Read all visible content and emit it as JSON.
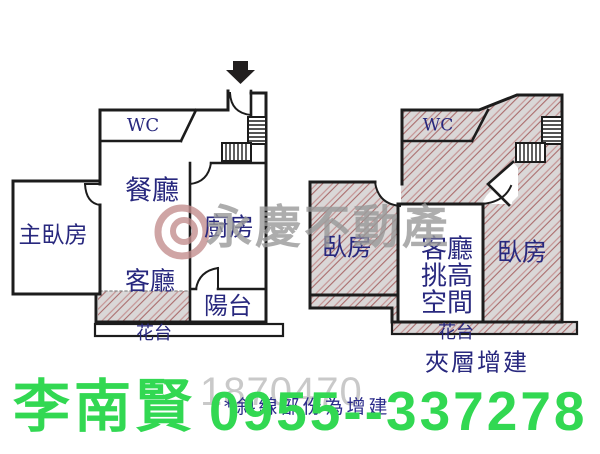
{
  "contact": {
    "name": "李南賢",
    "phone": "0955--337278"
  },
  "watermark": {
    "brand": "永慶不動產",
    "number": "1870470"
  },
  "notes": {
    "hatch_note": "*斜線部份為增建"
  },
  "left_plan": {
    "rooms": {
      "wc": "WC",
      "dining": "餐廳",
      "kitchen": "廚房",
      "master_bedroom": "主臥房",
      "living": "客廳",
      "balcony": "陽台",
      "flower_bed": "花台"
    }
  },
  "right_plan": {
    "rooms": {
      "wc": "WC",
      "bedroom_left": "臥房",
      "bedroom_right": "臥房",
      "flower_bed": "花台"
    },
    "loft_room": {
      "lines": [
        "客廳",
        "挑高",
        "空間"
      ]
    },
    "caption": "夾層增建"
  },
  "colors": {
    "wall": "#1c1c1c",
    "room_label": "#28287e",
    "hatch_background": "#dad7d7",
    "hatch_line": "#b97f7f",
    "contact_green": "#32d852",
    "watermark_gray": "#999999",
    "logo_red": "#c48f8f"
  }
}
